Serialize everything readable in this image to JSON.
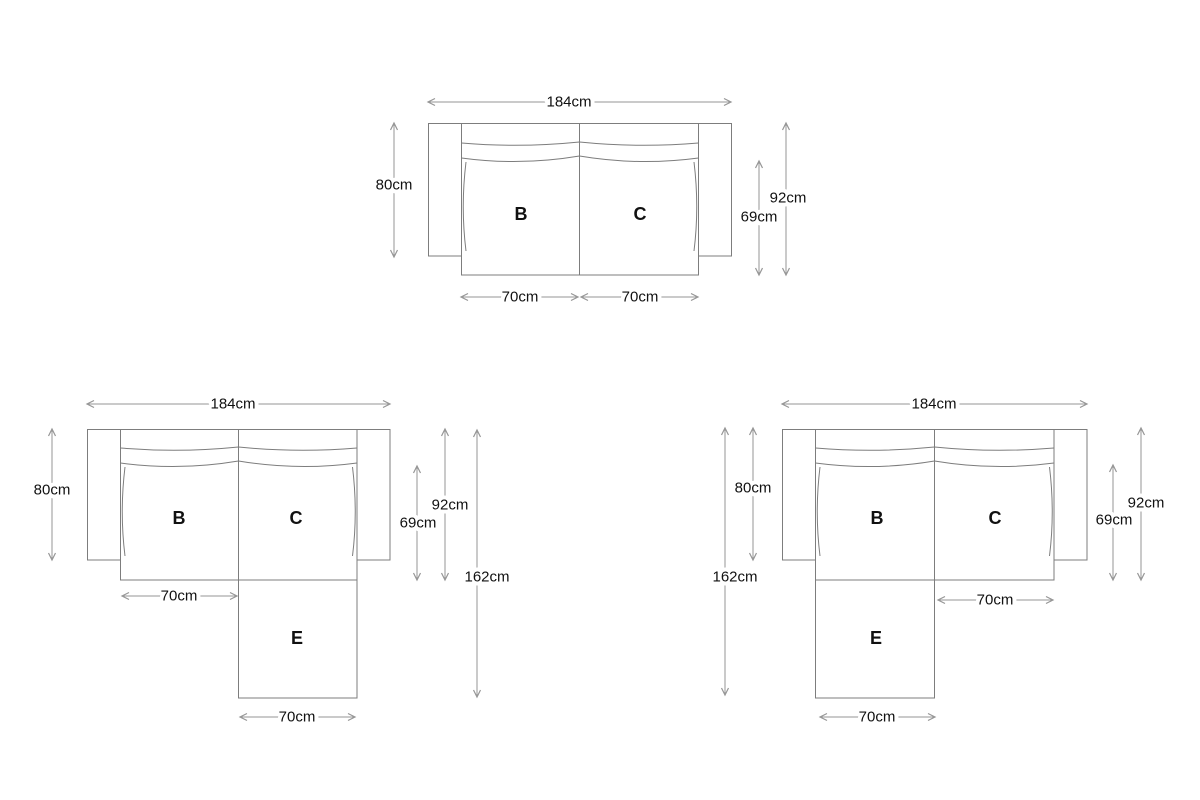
{
  "colors": {
    "background": "#ffffff",
    "sofa_line": "#7d7d7d",
    "dimension_line": "#969696",
    "label_text": "#111111"
  },
  "diagrams": {
    "two_seater": {
      "overall_width": "184cm",
      "arm_depth": "80cm",
      "seat_depth": "69cm",
      "overall_depth": "92cm",
      "seat_b_label": "B",
      "seat_c_label": "C",
      "seat_b_width": "70cm",
      "seat_c_width": "70cm"
    },
    "chaise_right": {
      "overall_width": "184cm",
      "arm_depth": "80cm",
      "seat_depth": "69cm",
      "overall_depth": "92cm",
      "overall_length": "162cm",
      "seat_b_label": "B",
      "seat_c_label": "C",
      "chaise_label": "E",
      "seat_b_width": "70cm",
      "chaise_width": "70cm"
    },
    "chaise_left": {
      "overall_width": "184cm",
      "arm_depth": "80cm",
      "seat_depth": "69cm",
      "overall_depth": "92cm",
      "overall_length": "162cm",
      "seat_b_label": "B",
      "seat_c_label": "C",
      "chaise_label": "E",
      "seat_c_width": "70cm",
      "chaise_width": "70cm"
    }
  }
}
